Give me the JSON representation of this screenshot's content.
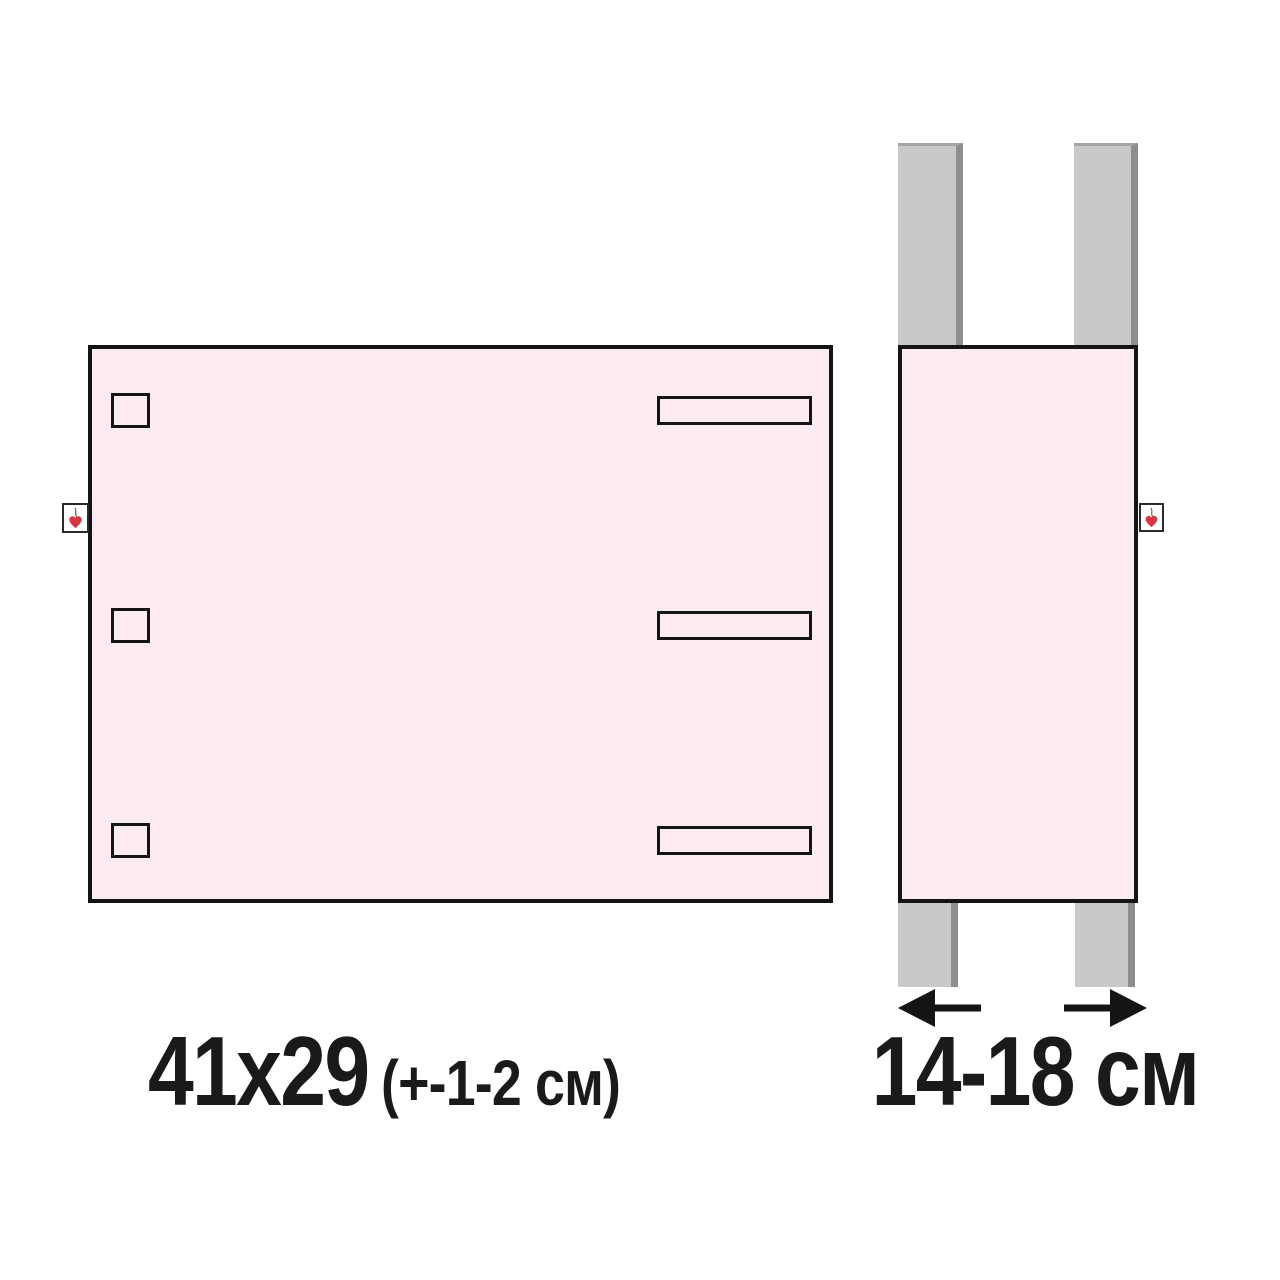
{
  "diagram": {
    "front_panel": {
      "size_label": "41x29",
      "tolerance_label": "(+-1-2 см)",
      "square_holes_count": 3,
      "slots_count": 3
    },
    "side_panel": {
      "strap_width_label": "14-18 см",
      "straps_count": 4
    },
    "icons": {
      "tag": "heart-sprout-icon",
      "arrow_left": "arrow-left-icon",
      "arrow_right": "arrow-right-icon"
    },
    "colors": {
      "background": "#ffffff",
      "panel_fill": "#fcecf2",
      "panel_border": "#141414",
      "strap_fill": "#c9c9c9",
      "strap_edge": "#8e8e8e",
      "tag_fill": "#ffffff",
      "heart_red": "#d23742",
      "text": "#1a1a1a"
    }
  }
}
